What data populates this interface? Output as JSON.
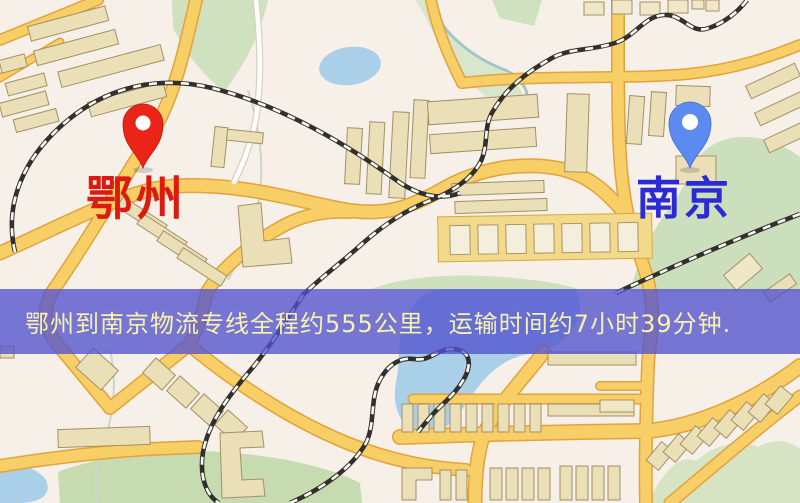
{
  "map": {
    "type": "static-route-map",
    "origin": {
      "name": "鄂州",
      "label_color": "#dc1a10",
      "pin_color": "#ea2517",
      "pin_style": "red-teardrop-marker"
    },
    "destination": {
      "name": "南京",
      "label_color": "#2b2bd4",
      "pin_color": "#5b8bee",
      "pin_style": "blue-teardrop-marker"
    },
    "banner": {
      "text": "鄂州到南京物流专线全程约555公里，运输时间约7小时39分钟.",
      "bg_color": "rgba(82,82,206,0.78)",
      "text_color": "#f8f2ac"
    },
    "route_facts": {
      "distance": "约555公里",
      "duration": "约7小时39分钟"
    },
    "palette": {
      "background": "#f6f0e8",
      "road_fill": "#f8cf66",
      "road_casing": "#e2a23c",
      "building": "#eadfb6",
      "water": "#a9cfe9",
      "park": "#ccdfbc",
      "railway": "#33302b"
    }
  }
}
